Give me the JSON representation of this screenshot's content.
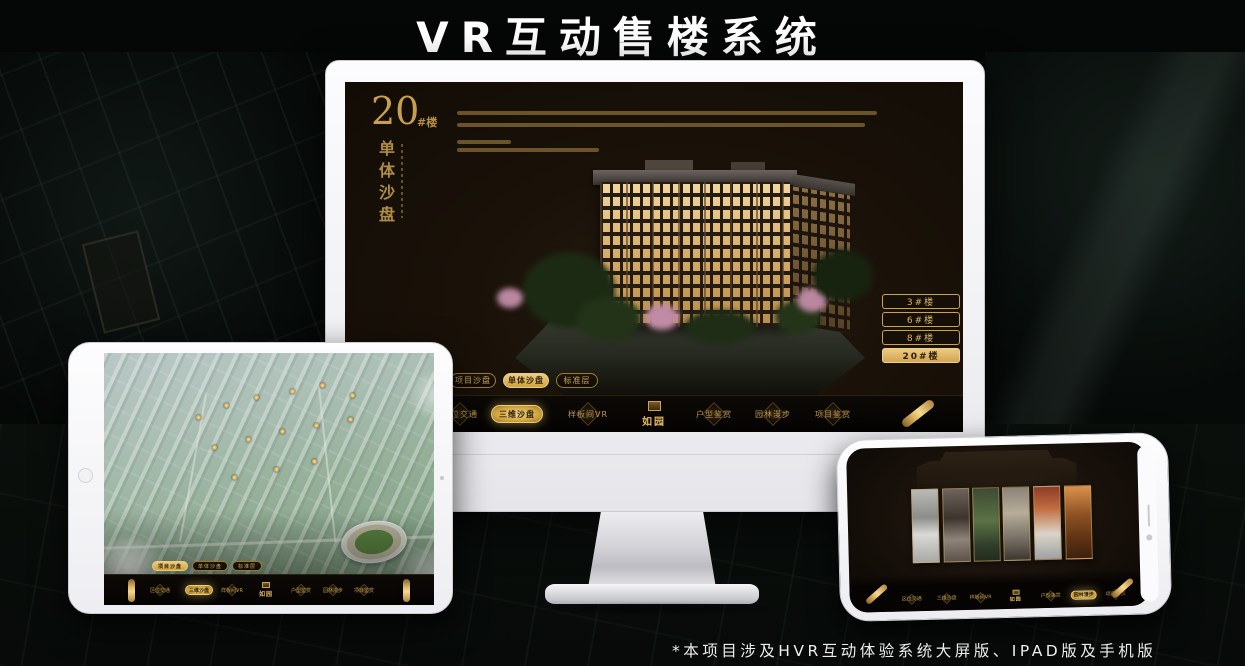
{
  "header": {
    "title": "VR互动售楼系统"
  },
  "footer": {
    "note": "*本项目涉及HVR互动体验系统大屏版、IPAD版及手机版"
  },
  "brand": {
    "name": "如园",
    "gold": "#d8ab56"
  },
  "monitor": {
    "hero": {
      "number": "20",
      "suffix": "#楼",
      "vertical_title": "单体沙盘"
    },
    "floor_buttons": [
      {
        "label": "3#楼",
        "active": false
      },
      {
        "label": "6#楼",
        "active": false
      },
      {
        "label": "8#楼",
        "active": false
      },
      {
        "label": "20#楼",
        "active": true
      }
    ],
    "tabs": [
      {
        "label": "项目沙盘",
        "active": false
      },
      {
        "label": "单体沙盘",
        "active": true
      },
      {
        "label": "标准层",
        "active": false
      }
    ],
    "nav": {
      "items": [
        {
          "label": "区位交通",
          "active": false
        },
        {
          "label": "三维沙盘",
          "active": true
        },
        {
          "label": "样板间VR",
          "active": false
        },
        {
          "label": "户型鉴赏",
          "active": false
        },
        {
          "label": "园林漫步",
          "active": false
        },
        {
          "label": "项目鉴赏",
          "active": false
        }
      ],
      "logo": "如园"
    }
  },
  "tablet": {
    "tabs": [
      {
        "label": "项目沙盘",
        "active": true
      },
      {
        "label": "单体沙盘",
        "active": false
      },
      {
        "label": "标准层",
        "active": false
      }
    ],
    "nav": {
      "items": [
        {
          "label": "区位交通",
          "active": false
        },
        {
          "label": "三维沙盘",
          "active": true
        },
        {
          "label": "样板间VR",
          "active": false
        },
        {
          "label": "户型鉴赏",
          "active": false
        },
        {
          "label": "园林漫步",
          "active": false
        },
        {
          "label": "项目鉴赏",
          "active": false
        }
      ],
      "logo": "如园"
    }
  },
  "phone": {
    "nav": {
      "items": [
        {
          "label": "区位交通",
          "active": false
        },
        {
          "label": "三维沙盘",
          "active": false
        },
        {
          "label": "样板间VR",
          "active": false
        },
        {
          "label": "户型鉴赏",
          "active": false
        },
        {
          "label": "园林漫步",
          "active": true
        },
        {
          "label": "项目鉴赏",
          "active": false
        }
      ],
      "logo": "如园"
    }
  }
}
